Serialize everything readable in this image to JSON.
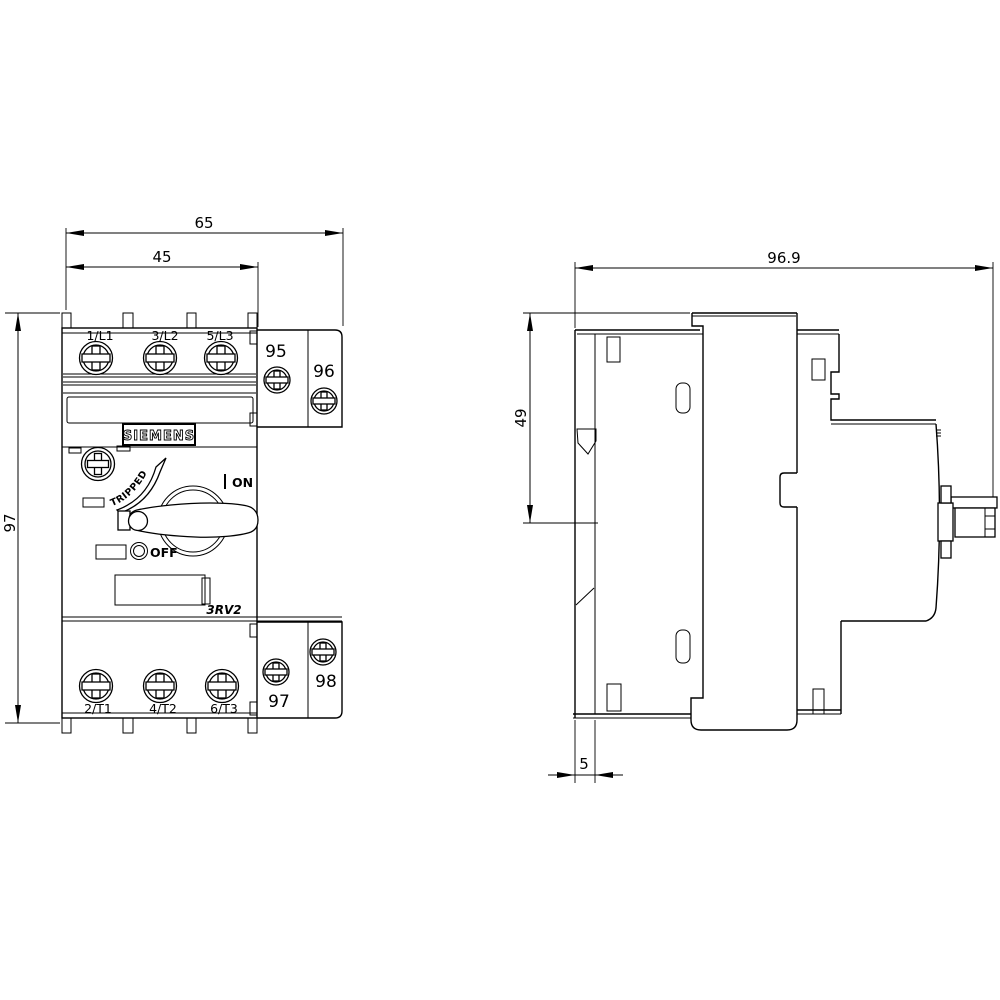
{
  "front_view": {
    "dim_total_width": "65",
    "dim_main_width": "45",
    "dim_height": "97",
    "brand": "SIEMENS",
    "model": "3RV2",
    "tripped_label": "TRIPPED",
    "on_label": "ON",
    "off_label": "OFF",
    "line_terminals": [
      "1/L1",
      "3/L2",
      "5/L3"
    ],
    "load_terminals": [
      "2/T1",
      "4/T2",
      "6/T3"
    ],
    "aux_terminals": [
      "95",
      "96",
      "97",
      "98"
    ]
  },
  "side_view": {
    "dim_total_depth": "96.9",
    "dim_body_depth": "49",
    "dim_rail_offset": "5"
  }
}
